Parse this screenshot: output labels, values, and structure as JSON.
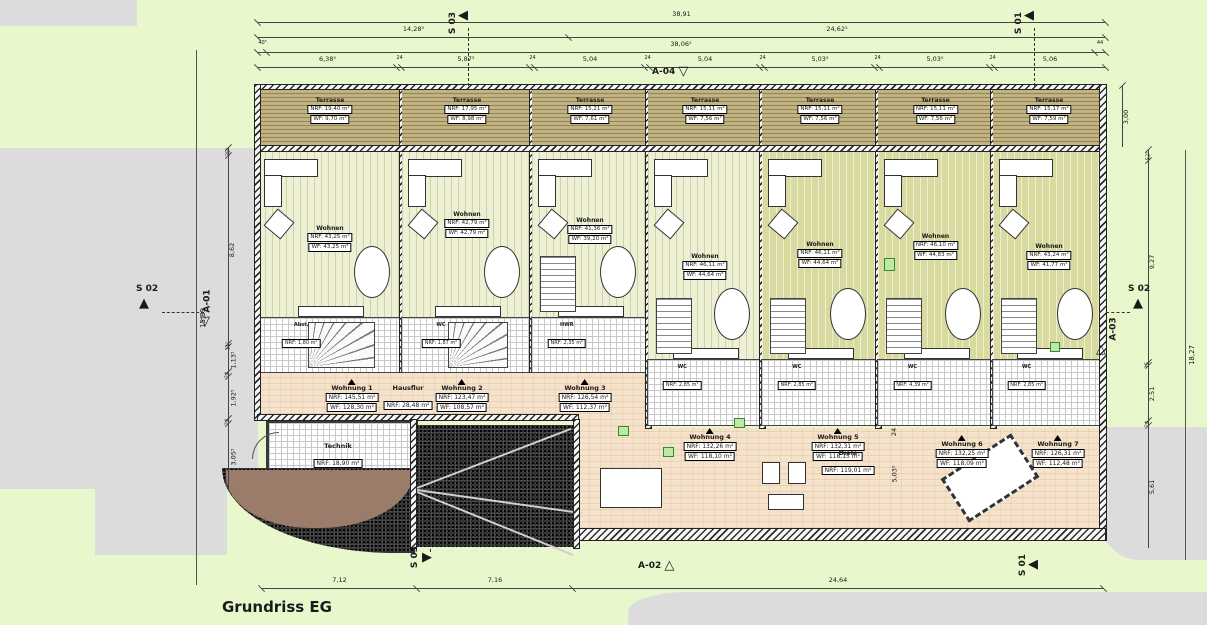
{
  "title": "Grundriss EG",
  "markers": {
    "s01": "S 01",
    "s02": "S 02",
    "s03": "S 03",
    "a01": "A-01",
    "a02": "A-02",
    "a03": "A-03",
    "a04": "A-04"
  },
  "icons": {
    "solid_left": "◀",
    "solid_right": "▶",
    "solid_up": "▲",
    "outline_down": "▽",
    "outline_up": "△"
  },
  "dims": {
    "top_total": "38,91",
    "top_split": [
      "14,28⁵",
      "24,62⁵"
    ],
    "top_row3": [
      "40⁵",
      "38,06⁵",
      "44"
    ],
    "top_chain": [
      "6,38⁵",
      "24",
      "5,87⁵",
      "24",
      "5,04",
      "24",
      "5,04",
      "24",
      "5,03⁵",
      "24",
      "5,03⁵",
      "24",
      "5,06"
    ],
    "left_chain": [
      "35⁵",
      "8,62",
      "11⁵",
      "1,13⁵",
      "24",
      "1,92⁵",
      "24",
      "3,05⁵"
    ],
    "left_total": "15,89",
    "right_depth": "3,00",
    "right_chain": [
      "52⁵",
      "9,27",
      "15",
      "2,51",
      "24",
      "5,61"
    ],
    "right_total": "18,27",
    "bottom": [
      "7,12",
      "7,16",
      "24,64"
    ],
    "hall_inner": [
      "24",
      "5,03⁵"
    ]
  },
  "units": [
    {
      "terrasse": {
        "name": "Terrasse",
        "nrf": "NRF: 19,40 m²",
        "wf": "WF: 9,70 m²"
      },
      "wohnen": {
        "name": "Wohnen",
        "nrf": "NRF: 43,25 m²",
        "wf": "WF: 43,25 m²"
      },
      "rooms": [
        {
          "name": "Abst.",
          "nrf": "NRF: 1,80 m²",
          "wf": "WF: 1,80 m²"
        },
        {
          "name": "WC",
          "nrf": "NRF: 1,80 m²",
          "wf": "WF: 1,80 m²"
        },
        {
          "name": "Flur",
          "nrf": "NRF: 9,68 m²",
          "wf": "WF: 9,29 m²"
        }
      ]
    },
    {
      "terrasse": {
        "name": "Terrasse",
        "nrf": "NRF: 17,95 m²",
        "wf": "WF: 8,98 m²"
      },
      "wohnen": {
        "name": "Wohnen",
        "nrf": "NRF: 42,79 m²",
        "wf": "WF: 42,79 m²"
      },
      "rooms": [
        {
          "name": "WC",
          "nrf": "NRF: 1,87 m²",
          "wf": "WF: 1,87 m²"
        },
        {
          "name": "Abst.",
          "nrf": "NRF: 1,87 m²",
          "wf": "WF: 1,87 m²"
        },
        {
          "name": "Flur",
          "nrf": "NRF: 9,68 m²",
          "wf": "WF: 9,30 m²"
        }
      ]
    },
    {
      "terrasse": {
        "name": "Terrasse",
        "nrf": "NRF: 15,21 m²",
        "wf": "WF: 7,61 m²"
      },
      "wohnen": {
        "name": "Wohnen",
        "nrf": "NRF: 41,36 m²",
        "wf": "WF: 39,20 m²"
      },
      "rooms": [
        {
          "name": "HWR",
          "nrf": "NRF: 2,35 m²",
          "wf": "WF: 2,11 m²"
        },
        {
          "name": "Flur",
          "nrf": "NRF: 2,87 m²",
          "wf": "WF: 2,87 m²"
        }
      ]
    },
    {
      "terrasse": {
        "name": "Terrasse",
        "nrf": "NRF: 15,11 m²",
        "wf": "WF: 7,56 m²"
      },
      "wohnen": {
        "name": "Wohnen",
        "nrf": "NRF: 46,11 m²",
        "wf": "WF: 44,64 m²"
      },
      "rooms": [
        {
          "name": "WC",
          "nrf": "NRF: 2,85 m²",
          "wf": "WF: 2,80 m²"
        },
        {
          "name": "Flur",
          "nrf": "NRF: 4,07 m²",
          "wf": "WF: 4,07 m²"
        },
        {
          "name": "HWR + Abst.",
          "nrf": "NRF: 4,04 m²",
          "wf": "WF: 4,04 m²"
        }
      ]
    },
    {
      "terrasse": {
        "name": "Terrasse",
        "nrf": "NRF: 15,11 m²",
        "wf": "WF: 7,56 m²"
      },
      "wohnen": {
        "name": "Wohnen",
        "nrf": "NRF: 46,11 m²",
        "wf": "WF: 44,64 m²"
      },
      "rooms": [
        {
          "name": "WC",
          "nrf": "NRF: 2,85 m²",
          "wf": "WF: 2,80 m²"
        },
        {
          "name": "Flur",
          "nrf": "NRF: 4,07 m²",
          "wf": "WF: 4,07 m²"
        },
        {
          "name": "HWR + Abst.",
          "nrf": "NRF: 4,04 m²",
          "wf": "WF: 4,04 m²"
        }
      ]
    },
    {
      "terrasse": {
        "name": "Terrasse",
        "nrf": "NRF: 15,11 m²",
        "wf": "WF: 7,56 m²"
      },
      "wohnen": {
        "name": "Wohnen",
        "nrf": "NRF: 46,10 m²",
        "wf": "WF: 44,83 m²"
      },
      "rooms": [
        {
          "name": "WC",
          "nrf": "NRF: 4,39 m²",
          "wf": "WF: 4,20 m²"
        },
        {
          "name": "Flur",
          "nrf": "NRF: 4,07 m²",
          "wf": "WF: 4,07 m²"
        },
        {
          "name": "HWR + Abst.",
          "nrf": "NRF: 4,04 m²",
          "wf": "WF: 4,04 m²"
        }
      ]
    },
    {
      "terrasse": {
        "name": "Terrasse",
        "nrf": "NRF: 15,17 m²",
        "wf": "WF: 7,59 m²"
      },
      "wohnen": {
        "name": "Wohnen",
        "nrf": "NRF: 43,24 m²",
        "wf": "WF: 41,77 m²"
      },
      "rooms": [
        {
          "name": "WC",
          "nrf": "NRF: 2,85 m²",
          "wf": "WF: 2,80 m²"
        },
        {
          "name": "Flur",
          "nrf": "NRF: 4,07 m²",
          "wf": "WF: 4,07 m²"
        },
        {
          "name": "HWR + Abst.",
          "nrf": "NRF: 4,04 m²",
          "wf": "WF: 4,04 m²"
        }
      ]
    }
  ],
  "apartments": [
    {
      "name": "Wohnung 1",
      "nrf": "NRF: 145,51 m²",
      "wf": "WF: 128,30 m²"
    },
    {
      "name": "Wohnung 2",
      "nrf": "NRF: 123,47 m²",
      "wf": "WF: 108,57 m²"
    },
    {
      "name": "Wohnung 3",
      "nrf": "NRF: 126,54 m²",
      "wf": "WF: 112,37 m²"
    },
    {
      "name": "Wohnung 4",
      "nrf": "NRF: 132,26 m²",
      "wf": "WF: 118,10 m²"
    },
    {
      "name": "Wohnung 5",
      "nrf": "NRF: 132,31 m²",
      "wf": "WF: 118,15 m²"
    },
    {
      "name": "Wohnung 6",
      "nrf": "NRF: 132,25 m²",
      "wf": "WF: 118,09 m²"
    },
    {
      "name": "Wohnung 7",
      "nrf": "NRF: 126,31 m²",
      "wf": "WF: 112,48 m²"
    }
  ],
  "hausflur": {
    "name": "Hausflur",
    "nrf": "NRF: 28,48 m²"
  },
  "diele": {
    "name": "Diele",
    "nrf": "NRF: 119,01 m²"
  },
  "technik": {
    "name": "Technik",
    "nrf": "NRF: 18,90 m²"
  }
}
